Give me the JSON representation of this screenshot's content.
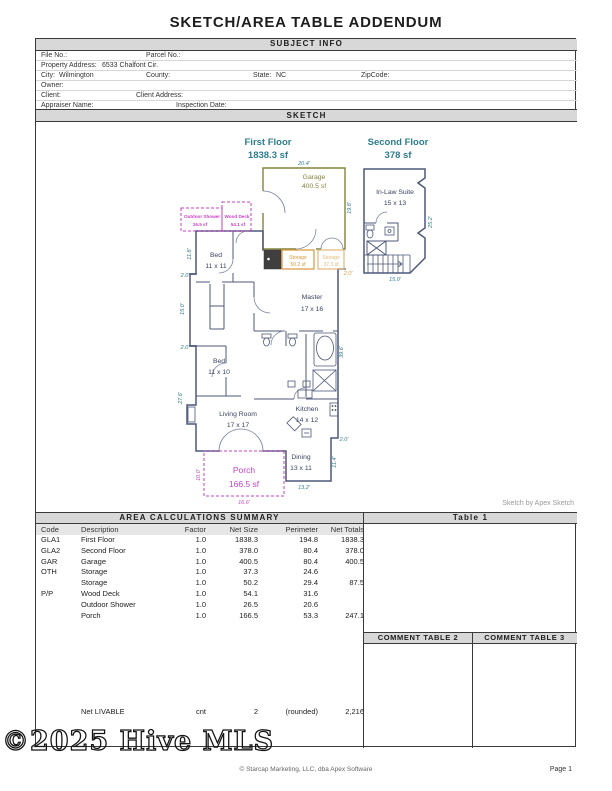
{
  "title": "SKETCH/AREA TABLE ADDENDUM",
  "subject": {
    "header": "SUBJECT INFO",
    "file_no": "File No.:",
    "parcel_no": "Parcel No.:",
    "property_address_label": "Property Address:",
    "property_address_value": "6533 Chalfont Cir.",
    "city_label": "City:",
    "city_value": "Wilmington",
    "county": "County:",
    "state_label": "State:",
    "state_value": "NC",
    "zipcode": "ZipCode:",
    "owner": "Owner:",
    "client": "Client:",
    "client_address": "Client Address:",
    "appraiser_name": "Appraiser Name:",
    "inspection_date": "Inspection Date:"
  },
  "sketch": {
    "header": "SKETCH",
    "credit": "Sketch by Apex Sketch",
    "first_floor_title": "First Floor",
    "first_floor_area": "1838.3 sf",
    "second_floor_title": "Second Floor",
    "second_floor_area": "378 sf",
    "rooms": {
      "garage": {
        "name": "Garage",
        "area": "400.5 sf"
      },
      "in_law_suite": {
        "name": "In-Law Suite",
        "size": "15 x 13"
      },
      "bed1": {
        "name": "Bed",
        "size": "11 x 11"
      },
      "bed2": {
        "name": "Bed",
        "size": "11 x 10"
      },
      "master": {
        "name": "Master",
        "size": "17 x 16"
      },
      "living_room": {
        "name": "Living Room",
        "size": "17 x 17"
      },
      "kitchen": {
        "name": "Kitchen",
        "size": "14 x 12"
      },
      "dining": {
        "name": "Dining",
        "size": "13 x 11"
      },
      "storage1": {
        "name": "Storage",
        "area": "50.2 sf"
      },
      "storage2": {
        "name": "Storage",
        "area": "37.3 sf"
      },
      "porch": {
        "name": "Porch",
        "area": "166.5 sf"
      },
      "wood_deck": {
        "name": "Wood Deck",
        "area": "54.1 sf"
      },
      "outdoor_shower": {
        "name": "Outdoor Shower",
        "area": "26.5 sf"
      }
    },
    "dims": {
      "garage_width": "20.4'",
      "garage_depth": "19.8'",
      "second_depth": "25.2'",
      "second_width": "15.0'",
      "left_top": "11.8'",
      "left_jog1": "2.0'",
      "left_mid": "15.0'",
      "left_jog2": "2.0'",
      "left_bottom": "27.6'",
      "right_side": "39.6'",
      "storage_jog": "2.0'",
      "kitchen_jog": "2.0'",
      "dining_right": "11.4'",
      "dining_bottom": "13.2'",
      "porch_left": "10.0'",
      "porch_bottom": "16.6'"
    },
    "colors": {
      "walls": "#4d5878",
      "dimensions": "#2e7d8e",
      "garage": "#83843b",
      "storage_dark": "#d8973c",
      "storage_light": "#e3b878",
      "porch_pp": "#c93fc3",
      "header_bar_bg": "#d8d8d8"
    }
  },
  "area_table": {
    "header": "AREA CALCULATIONS SUMMARY",
    "columns": {
      "code": "Code",
      "description": "Description",
      "factor": "Factor",
      "net_size": "Net Size",
      "perimeter": "Perimeter",
      "net_totals": "Net Totals"
    },
    "rows": [
      {
        "code": "GLA1",
        "description": "First Floor",
        "factor": "1.0",
        "net_size": "1838.3",
        "perimeter": "194.8",
        "net_totals": "1838.3"
      },
      {
        "code": "GLA2",
        "description": "Second Floor",
        "factor": "1.0",
        "net_size": "378.0",
        "perimeter": "80.4",
        "net_totals": "378.0"
      },
      {
        "code": "GAR",
        "description": "Garage",
        "factor": "1.0",
        "net_size": "400.5",
        "perimeter": "80.4",
        "net_totals": "400.5"
      },
      {
        "code": "OTH",
        "description": "Storage",
        "factor": "1.0",
        "net_size": "37.3",
        "perimeter": "24.6",
        "net_totals": ""
      },
      {
        "code": "",
        "description": "Storage",
        "factor": "1.0",
        "net_size": "50.2",
        "perimeter": "29.4",
        "net_totals": "87.5"
      },
      {
        "code": "P/P",
        "description": "Wood Deck",
        "factor": "1.0",
        "net_size": "54.1",
        "perimeter": "31.6",
        "net_totals": ""
      },
      {
        "code": "",
        "description": "Outdoor Shower",
        "factor": "1.0",
        "net_size": "26.5",
        "perimeter": "20.6",
        "net_totals": ""
      },
      {
        "code": "",
        "description": "Porch",
        "factor": "1.0",
        "net_size": "166.5",
        "perimeter": "53.3",
        "net_totals": "247.1"
      }
    ],
    "net_livable": {
      "label": "Net LIVABLE",
      "unit": "cnt",
      "count": "2",
      "note": "(rounded)",
      "total": "2,216"
    }
  },
  "side_tables": {
    "table1": "Table 1",
    "comment2": "COMMENT TABLE 2",
    "comment3": "COMMENT TABLE 3"
  },
  "watermark": "©2025 Hive MLS",
  "footer": {
    "copyright": "© Starcap Marketing, LLC, dba Apex Software",
    "page": "Page 1"
  }
}
